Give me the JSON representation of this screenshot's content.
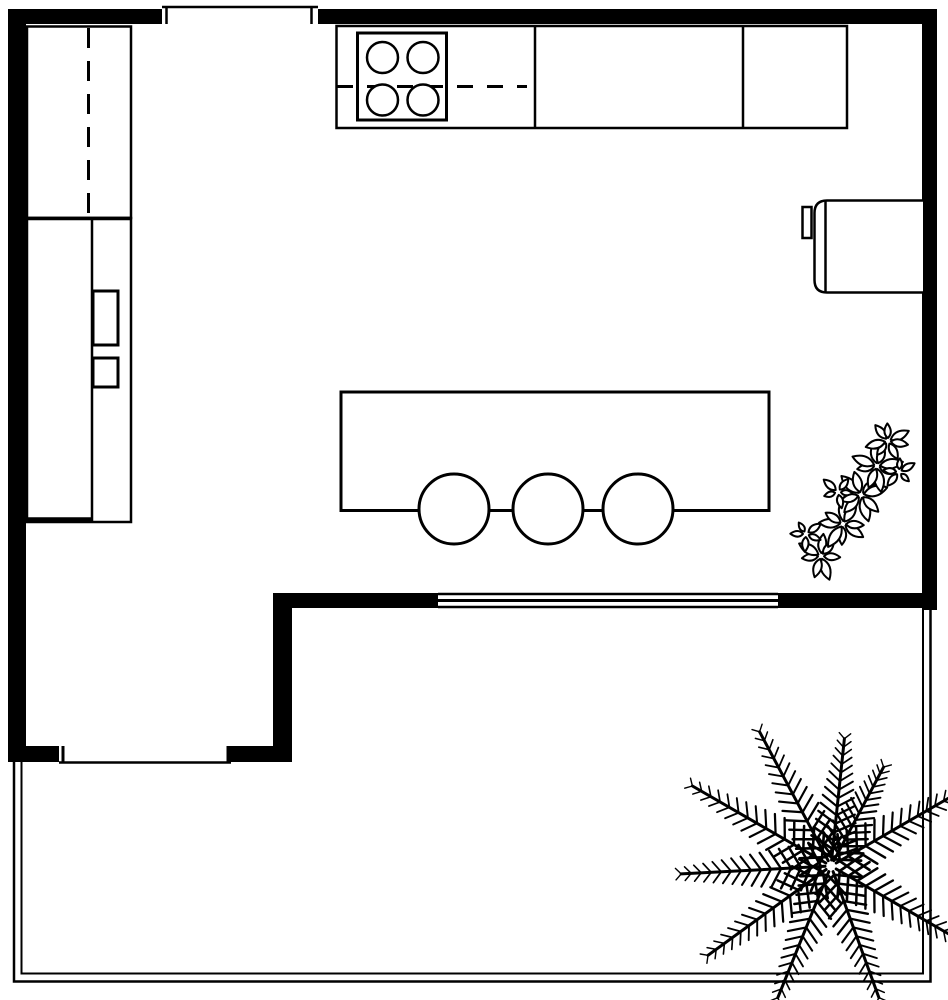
{
  "title": "Kitchen floor plan with patio",
  "colors": {
    "wall": "#000000",
    "line": "#000000",
    "background": "#ffffff"
  },
  "rooms": [
    {
      "name": "Kitchen"
    },
    {
      "name": "Patio"
    }
  ],
  "items": {
    "walls": "Exterior walls",
    "window_top": "Window",
    "sliding_door": "Sliding glass door",
    "entry_window": "Window",
    "tall_cabinet": "Tall cabinet with dashed upper-cabinet line",
    "tall_unit": "Tall unit / refrigerator with two door handles",
    "counter": "Kitchen countertop",
    "cooktop": "Cooktop",
    "burner_count": 4,
    "wall_appliance": "Wall appliance with handle",
    "island": "Kitchen island",
    "stools": "Bar stools",
    "stool_count": 3,
    "plant_shrub": "Leafy plant",
    "plant_palm": "Palm plant",
    "patio_border": "Patio boundary"
  }
}
